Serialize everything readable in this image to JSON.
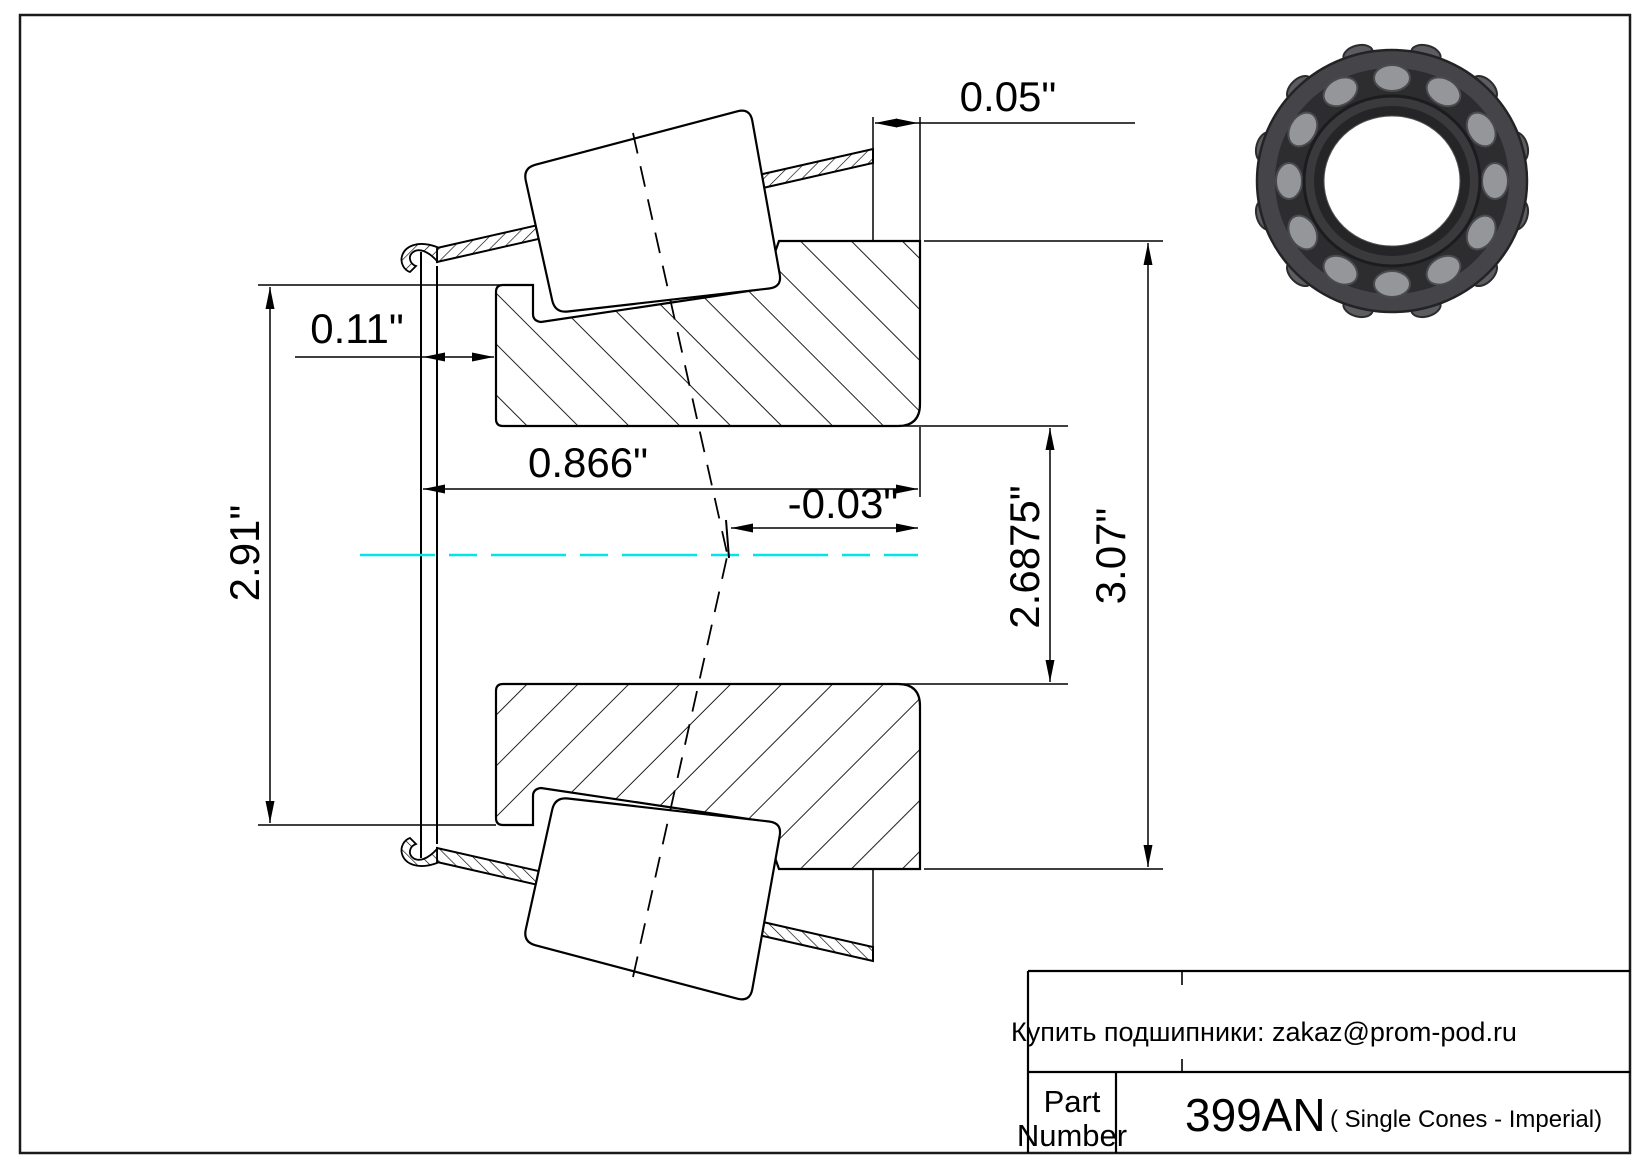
{
  "drawing": {
    "type": "tapered-roller-bearing-single-cone-section",
    "dimensions": {
      "cage_protrusion": "0.05\"",
      "front_face_step": "0.11\"",
      "cage_small_end_od": "2.91\"",
      "cone_width": "0.866\"",
      "effective_center_offset": "-0.03\"",
      "bore_diameter": "2.6875\"",
      "large_end_od": "3.07\""
    },
    "colors": {
      "centerline": "#00E5E8",
      "line": "#000000"
    }
  },
  "title_block": {
    "contact_line": "Купить подшипники: zakaz@prom-pod.ru",
    "part_label_line1": "Part",
    "part_label_line2": "Number",
    "part_number": "399AN",
    "part_series": "( Single Cones - Imperial)"
  },
  "photo": {
    "description": "tapered-roller-bearing-photo"
  }
}
